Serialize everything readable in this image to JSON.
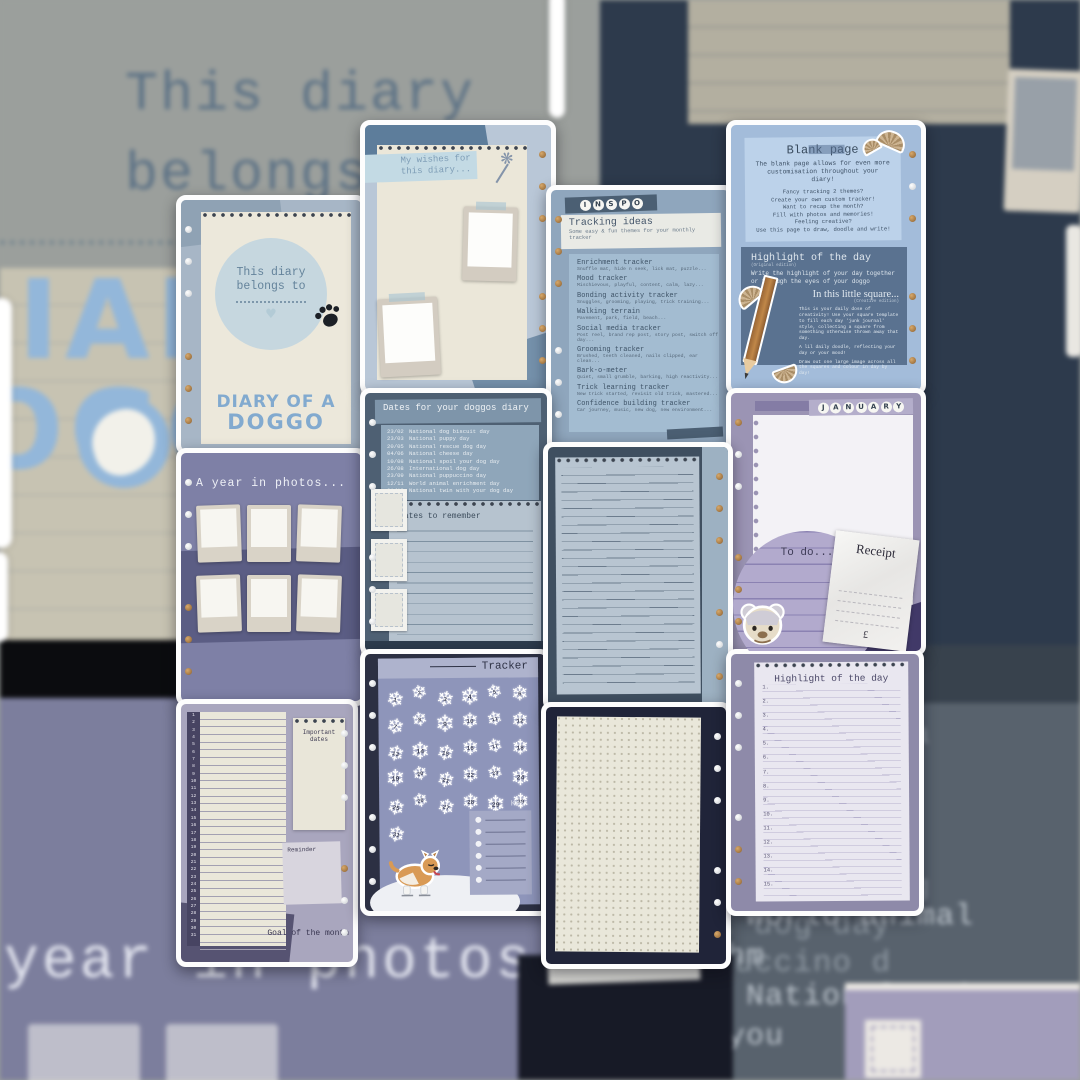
{
  "background": {
    "top_left": {
      "line1": "This diary",
      "line2": "belongs to"
    },
    "logo": {
      "row1": "IARY",
      "row2": "OGG"
    },
    "bottom_left_caption": "year in photos...",
    "right_title": "ur doggos",
    "right_items": [
      "dog biscuit da",
      "puppy day",
      "rescue dog da",
      "cheese day",
      "spoil your dog",
      "onal dog day",
      "puppuccino d"
    ],
    "right_dates": [
      "12/11  World animal enrichm",
      "01/12  National twin with you"
    ]
  },
  "cards": {
    "belongs": {
      "line1": "This diary",
      "line2": "belongs to",
      "brand1": "DIARY OF A",
      "brand2": "DOGGO"
    },
    "wishes": {
      "title1": "My wishes for",
      "title2": "this diary..."
    },
    "photos": {
      "title": "A year in photos..."
    },
    "monthly": {
      "days": [
        1,
        2,
        3,
        4,
        5,
        6,
        7,
        8,
        9,
        10,
        11,
        12,
        13,
        14,
        15,
        16,
        17,
        18,
        19,
        20,
        21,
        22,
        23,
        24,
        25,
        26,
        27,
        28,
        29,
        30,
        31
      ],
      "important": "Important dates",
      "reminder": "Reminder",
      "goal": "Goal of the month"
    },
    "dates": {
      "title": "Dates for your doggos diary",
      "entries": [
        {
          "date": "23/02",
          "label": "National dog biscuit day"
        },
        {
          "date": "23/03",
          "label": "National puppy day"
        },
        {
          "date": "20/05",
          "label": "National rescue dog day"
        },
        {
          "date": "04/06",
          "label": "National cheese day"
        },
        {
          "date": "10/08",
          "label": "National spoil your dog day"
        },
        {
          "date": "26/08",
          "label": "International dog day"
        },
        {
          "date": "23/09",
          "label": "National puppuccino day"
        },
        {
          "date": "12/11",
          "label": "World animal enrichment day"
        },
        {
          "date": "01/12",
          "label": "National twin with your dog day"
        }
      ],
      "notes_title": "Dates to remember"
    },
    "tracker": {
      "title": "Tracker",
      "flake": "❄",
      "days": [
        1,
        2,
        3,
        4,
        5,
        6,
        7,
        8,
        9,
        10,
        11,
        12,
        13,
        14,
        15,
        16,
        17,
        18,
        19,
        20,
        21,
        22,
        23,
        24,
        25,
        26,
        27,
        28,
        29,
        30,
        31
      ],
      "key_label": "Key"
    },
    "inspo": {
      "beads": [
        "I",
        "N",
        "S",
        "P",
        "O"
      ],
      "title": "Tracking ideas",
      "subtitle": "Some easy & fun themes for your monthly tracker",
      "items": [
        {
          "name": "Enrichment tracker",
          "detail": "Snuffle mat, hide n seek, lick mat, puzzle..."
        },
        {
          "name": "Mood tracker",
          "detail": "Mischievous, playful, content, calm, lazy..."
        },
        {
          "name": "Bonding activity tracker",
          "detail": "Snuggles, grooming, playing, trick training..."
        },
        {
          "name": "Walking terrain",
          "detail": "Pavement, park, field, beach..."
        },
        {
          "name": "Social media tracker",
          "detail": "Post reel, brand rep post, story post, switch off day..."
        },
        {
          "name": "Grooming tracker",
          "detail": "Brushed, teeth cleaned, nails clipped, ear clean..."
        },
        {
          "name": "Bark-o-meter",
          "detail": "Quiet, small grumble, barking, high reactivity..."
        },
        {
          "name": "Trick learning tracker",
          "detail": "New trick started, revisit old trick, mastered..."
        },
        {
          "name": "Confidence building tracker",
          "detail": "Car journey, music, new dog, new environment..."
        }
      ]
    },
    "blank": {
      "title": "Blank page",
      "intro": "The blank page allows for even more customisation throughout your diary!",
      "lines": [
        "Fancy tracking 2 themes?",
        "Create your own custom tracker!",
        "Want to recap the month?",
        "Fill with photos and memories!",
        "Feeling creative?",
        "Use this page to draw, doodle and write!"
      ],
      "highlight_title": "Highlight of the day",
      "highlight_edition": "(Original edition)",
      "highlight_body": "Write the highlight of your day together or through the eyes of your doggo",
      "square_title": "In this little square...",
      "square_edition": "(Creative edition)",
      "square_p1": "This is your daily dose of creativity! Use your square template to fill each day 'junk journal' style, collecting a square from something otherwise thrown away that day.",
      "square_p2": "A lil daily doodle, reflecting your day or your mood!",
      "square_p3": "Draw out one large image across all the squares and colour in day by day!"
    },
    "january": {
      "beads": [
        "J",
        "A",
        "N",
        "U",
        "A",
        "R",
        "Y"
      ],
      "todo": "To do...",
      "receipt_title": "Receipt",
      "currency": "£"
    },
    "hlpage": {
      "title": "Highlight of the day",
      "rows": [
        "1.",
        "2.",
        "3.",
        "4.",
        "5.",
        "6.",
        "7.",
        "8.",
        "9.",
        "10.",
        "11.",
        "12.",
        "13.",
        "14.",
        "15."
      ]
    }
  }
}
